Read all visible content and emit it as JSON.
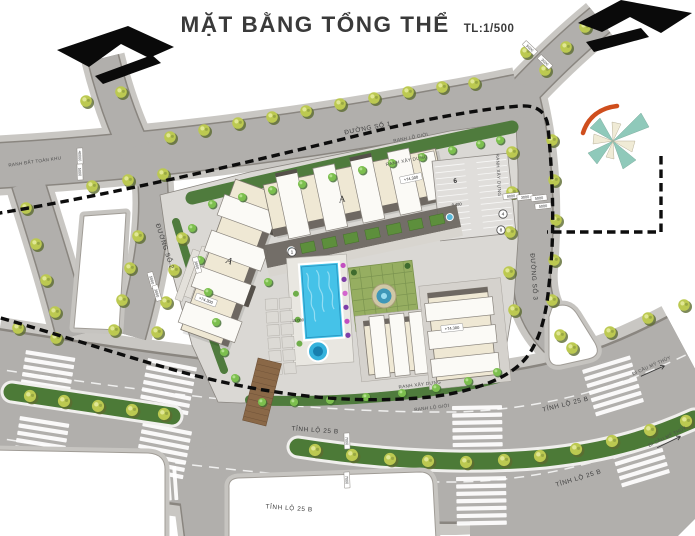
{
  "title": {
    "text": "MẶT BẰNG TỔNG THỂ",
    "scale": "TL:1/500"
  },
  "labels": {
    "road1": "ĐƯỜNG SỐ 1",
    "road2": "ĐƯỜNG SỐ 2",
    "road3": "ĐƯỜNG SỐ 3",
    "provincial_road": "TỈNH LỘ 25 B",
    "to_my_thuy_bridge": "ĐI CẦU MỸ THỦY",
    "site_boundary": "RANH ĐẤT TOÀN KHU",
    "row_boundary": "RANH LỘ GIỚI",
    "construction_boundary": "RANH XÂY DỰNG"
  },
  "buildings": {
    "block_a": "A",
    "parking_lot": "6",
    "marker_1": "1",
    "marker_4": "4",
    "marker_8": "8"
  },
  "elevations": {
    "roof_north": "+74.300",
    "roof_west": "+74.300",
    "roof_south": "+74.300",
    "parking_level": "0.480",
    "pool_deck": "+15.000"
  },
  "dimensions": [
    "40000",
    "5000",
    "5000",
    "3000",
    "3000",
    "8000",
    "3000",
    "5000",
    "5000",
    "5000",
    "3000",
    "7000",
    "7000"
  ],
  "colors": {
    "road": "#b1afac",
    "sidewalk": "#c9c7c3",
    "curb": "#8a8680",
    "site": "#dad8d4",
    "building": "#efe8d4",
    "roof_dark": "#6e6862",
    "green_strip": "#4f7b3d",
    "median_green": "#4c7a37",
    "tree": "#bcc951",
    "tree_bright": "#7cbf4e",
    "pool_blue": "#45c2e8",
    "boundary": "#111111",
    "compass_teal": "#8fc9ba",
    "compass_cream": "#f0ebd6",
    "north_arrow": "#0a0a0a",
    "accent_red": "#cf4e1d"
  }
}
